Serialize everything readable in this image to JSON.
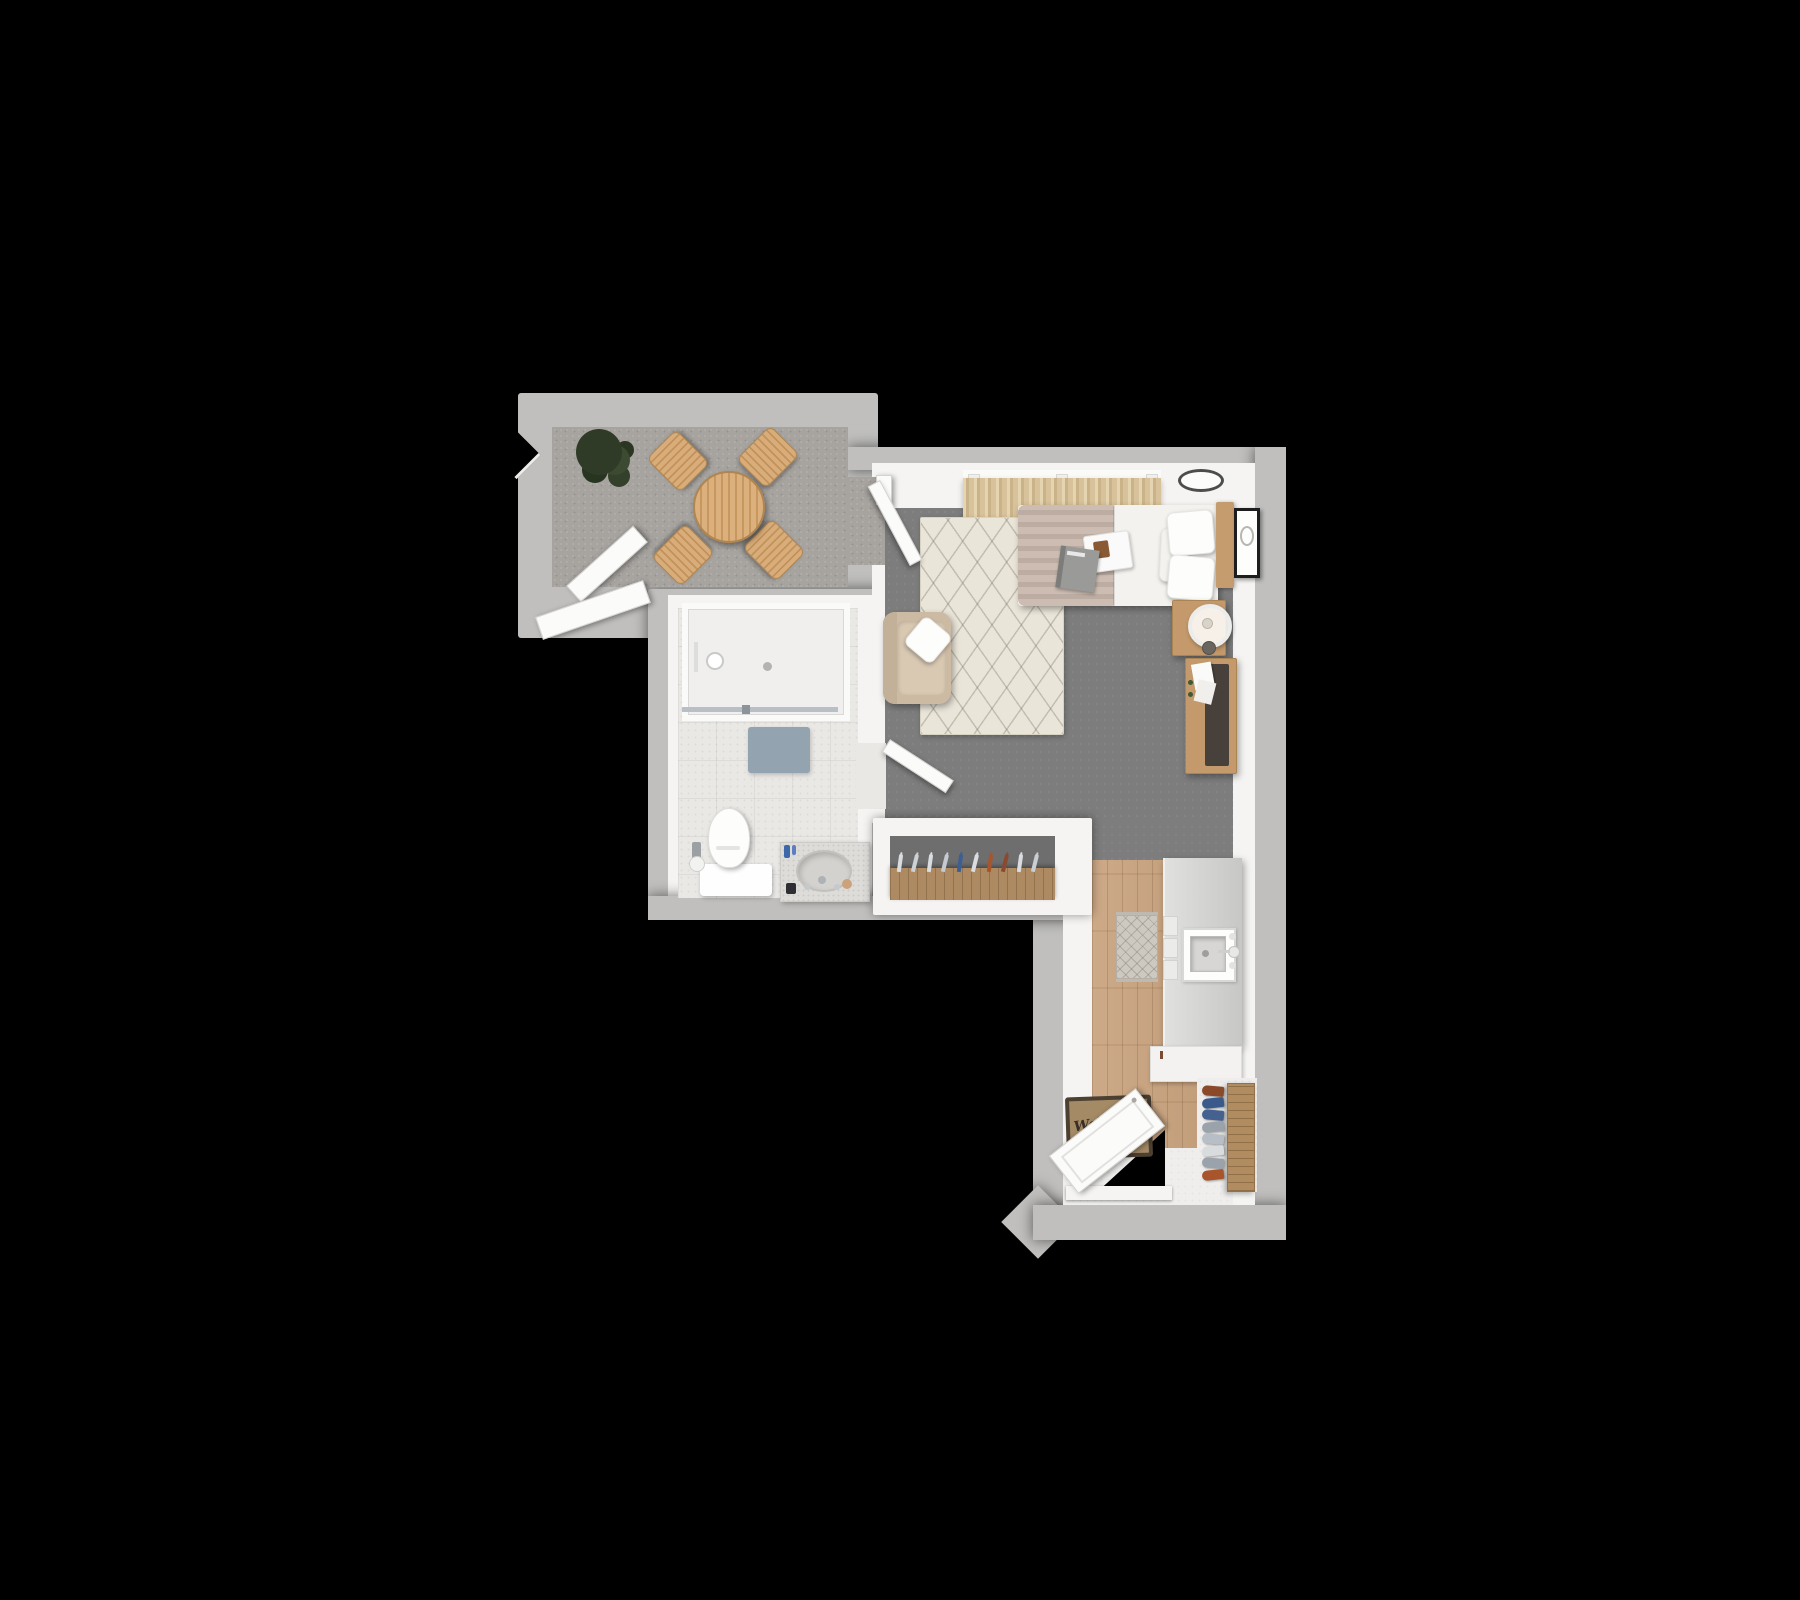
{
  "scene": {
    "title": "3D rendered top-down apartment floor plan on black background",
    "background": "#000000"
  },
  "palette": {
    "outer_wall": "#c0bfbd",
    "inner_wall": "#f5f4f2",
    "balcony_floor": "#a7a4a0",
    "living_floor": "#7d7d7d",
    "bathroom_floor": "#e9e8e5",
    "kitchen_wood_floor": "#c9a37e",
    "rug_cream": "#eae5d9",
    "wood_furniture": "#c49a6c",
    "outdoor_table_wood": "#d9ad79",
    "duvet_beige": "#c6b5aa",
    "linen_white": "#f4f2ef",
    "curtain_beige": "#d8c29b",
    "armchair_beige": "#cdbaa3",
    "bath_mat_blue": "#93a3af",
    "desk_top_dark": "#48403a",
    "plant_green": "#34402b",
    "closet_wood": "#ad8a62",
    "welcome_mat_tan": "#a58a66",
    "welcome_mat_border": "#4c4033"
  },
  "rooms": [
    {
      "name": "Balcony",
      "floor": "gray outdoor carpet",
      "furniture": [
        "potted plant",
        "round wooden dining table",
        "four wooden chairs",
        "angled glazed doors"
      ]
    },
    {
      "name": "Living / Bedroom",
      "floor": "dark gray carpet",
      "furniture": [
        "bed with beige duvet, white sheet, two pillows",
        "wood headboard",
        "serving tray",
        "magazine",
        "wall art frame",
        "ceiling lamp",
        "window curtains",
        "nightstand with lamp and cup",
        "desk with dark top and papers",
        "beige armchair with white throw pillow",
        "cream berber rug"
      ]
    },
    {
      "name": "Bathroom",
      "floor": "light tile",
      "furniture": [
        "walk-in shower with glass panel",
        "shower head",
        "floor drain",
        "bath mat",
        "toilet with mat",
        "toilet paper holder",
        "vanity with oval sink and accessories"
      ]
    },
    {
      "name": "Hall Closet",
      "floor": "dark gray carpet",
      "furniture": [
        "open wardrobe with wooden rail",
        "clothes hangers"
      ]
    },
    {
      "name": "Kitchen / Entry",
      "floor": "oak plank",
      "furniture": [
        "kitchen counter with square sink and drawers",
        "base cabinet",
        "runner rug",
        "shoe rack with shoes",
        "welcome mat",
        "entry door"
      ]
    }
  ],
  "closet": {
    "hanger_colors": [
      "#d9dde0",
      "#ccd1d5",
      "#d9dde0",
      "#c4cacf",
      "#3c5e93",
      "#d9dde0",
      "#a8552b",
      "#8a4a2f",
      "#d9dde0",
      "#c9ced2"
    ]
  },
  "entry": {
    "welcome_mat_text": "Welcome",
    "shoe_colors": [
      "#8a4a2a",
      "#3a5a8c",
      "#44618f",
      "#9aa2ab",
      "#b8bec5",
      "#d8dcdf",
      "#9aa2ab",
      "#a8552b"
    ]
  }
}
